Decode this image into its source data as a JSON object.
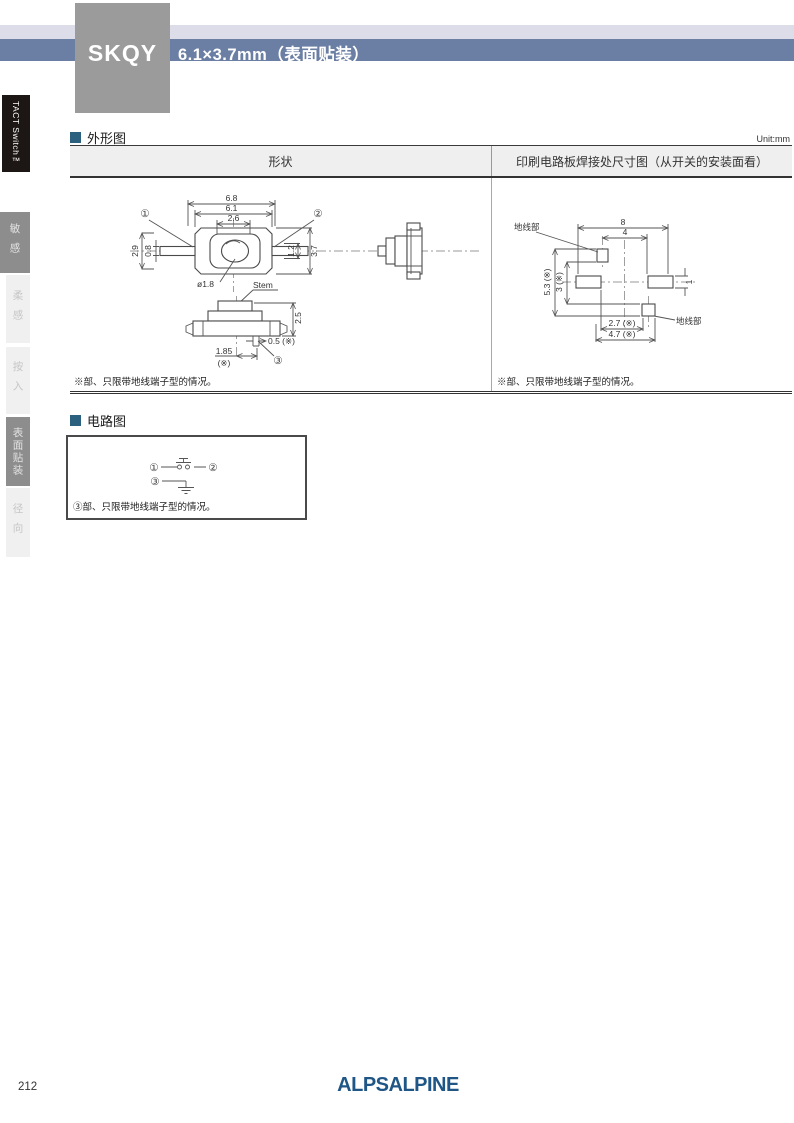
{
  "header": {
    "model": "SKQY",
    "title": "6.1×3.7mm（表面贴装）",
    "series": "TACT Switch™"
  },
  "sidebar": {
    "items": [
      {
        "label": "敏感",
        "active": true
      },
      {
        "label": "柔感",
        "active": false
      },
      {
        "label": "按入",
        "active": false
      },
      {
        "label": "表面贴装",
        "active": true
      },
      {
        "label": "径向",
        "active": false
      }
    ]
  },
  "outline": {
    "title": "外形图",
    "unit": "Unit:mm",
    "col_shape": "形状",
    "col_pcb": "印刷电路板焊接处尺寸图（从开关的安装面看）",
    "note": "※部、只限带地线端子型的情况。",
    "top_view": {
      "dim_68": "6.8",
      "dim_61": "6.1",
      "dim_26": "2.6",
      "dim_29": "2.9",
      "dim_08": "0.8",
      "dim_12": "1.2",
      "dim_37": "3.7",
      "dim_dia": "ø1.8",
      "stem": "Stem",
      "c1": "①",
      "c2": "②"
    },
    "front_view": {
      "dim_25": "2.5",
      "dim_05": "0.5 (※)",
      "dim_185": "1.85",
      "dim_185_sub": "(※)",
      "c3": "③"
    },
    "pcb_view": {
      "dim_8": "8",
      "dim_4": "4",
      "dim_53": "5.3 (※)",
      "dim_3": "3 (※)",
      "dim_1": "1",
      "dim_27": "2.7 (※)",
      "dim_47": "4.7 (※)",
      "gnd_top": "地线部",
      "gnd_bottom": "地线部"
    }
  },
  "circuit": {
    "title": "电路图",
    "t1": "①",
    "t2": "②",
    "t3": "③",
    "note": "③部、只限带地线端子型的情况。"
  },
  "footer": {
    "page_number": "212",
    "logo": "ALPSALPINE"
  },
  "colors": {
    "header_bar": "#6b7ea3",
    "header_band": "#dcdde9",
    "model_box": "#9b9b9b",
    "series_tab_bg": "#1c1714",
    "section_marker": "#2c607f",
    "sidebar_active": "#8d8d8d",
    "sidebar_inactive": "#f0f0f0",
    "logo": "#1f5686",
    "drawing_line": "#555555"
  }
}
